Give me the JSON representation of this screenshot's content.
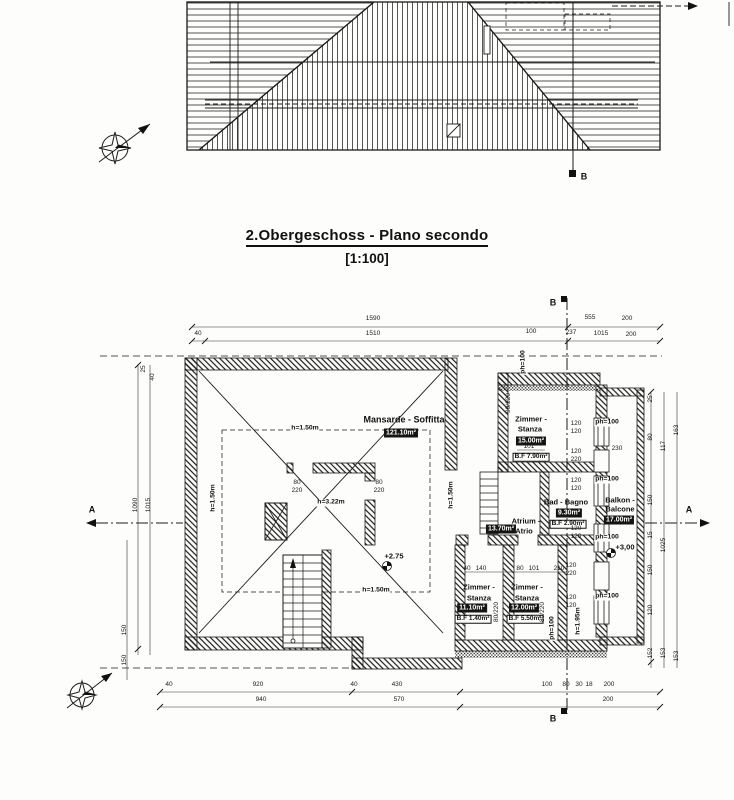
{
  "title": {
    "heading": "2.Obergeschoss - Plano secondo",
    "scale": "[1:100]"
  },
  "plan": {
    "rooms": {
      "mansarde": {
        "name": "Mansarde - Soffitta",
        "area": "121.10m²"
      },
      "zimmer_top": {
        "line1": "Zimmer -",
        "line2": "Stanza",
        "area": "15.00m²",
        "floor": "B.F 7.90m²"
      },
      "bad": {
        "name": "Bad - Bagno",
        "area": "9.30m²",
        "floor": "B.F 2.90m²"
      },
      "atrium": {
        "line1": "Atrium -",
        "line2": "Atrio",
        "area": "13.70m²"
      },
      "zimmer_sw": {
        "line1": "Zimmer -",
        "line2": "Stanza",
        "area": "11.10m²",
        "floor": "B.F 1.40m²"
      },
      "zimmer_s": {
        "line1": "Zimmer -",
        "line2": "Stanza",
        "area": "12.00m²",
        "floor": "B.F 5.50m²"
      },
      "balkon": {
        "line1": "Balkon -",
        "line2": "Balcone",
        "area": "17.00m²"
      }
    },
    "levels": {
      "mansarde": "+2.75",
      "balkon": "+3,00"
    },
    "sections": {
      "a": "A",
      "b": "B"
    }
  },
  "annotations": [
    {
      "t": "h=1.50m",
      "x": 305,
      "y": 429
    },
    {
      "t": "h=1.50m",
      "x": 214,
      "y": 498,
      "r": -90
    },
    {
      "t": "h=1.50m",
      "x": 452,
      "y": 495,
      "r": -90
    },
    {
      "t": "h=1.50m",
      "x": 376,
      "y": 591
    },
    {
      "t": "h=3.22m",
      "x": 331,
      "y": 503
    },
    {
      "t": "h=1.95m",
      "x": 579,
      "y": 621,
      "r": -90
    },
    {
      "t": "ph=100",
      "x": 607,
      "y": 423
    },
    {
      "t": "ph=100",
      "x": 607,
      "y": 480
    },
    {
      "t": "ph=100",
      "x": 607,
      "y": 538
    },
    {
      "t": "ph=100",
      "x": 607,
      "y": 597
    },
    {
      "t": "ph=100",
      "x": 524,
      "y": 362,
      "r": -90
    },
    {
      "t": "ph=100",
      "x": 553,
      "y": 628,
      "r": -90
    }
  ],
  "dimensions": [
    {
      "t": "1590",
      "x": 373,
      "y": 319
    },
    {
      "t": "40",
      "x": 198,
      "y": 334
    },
    {
      "t": "1510",
      "x": 373,
      "y": 334
    },
    {
      "t": "555",
      "x": 590,
      "y": 318
    },
    {
      "t": "200",
      "x": 627,
      "y": 319
    },
    {
      "t": "100",
      "x": 531,
      "y": 332
    },
    {
      "t": "237",
      "x": 571,
      "y": 333
    },
    {
      "t": "1015",
      "x": 601,
      "y": 334
    },
    {
      "t": "200",
      "x": 631,
      "y": 335
    },
    {
      "t": "25",
      "x": 144,
      "y": 369,
      "r": -90
    },
    {
      "t": "40",
      "x": 153,
      "y": 377,
      "r": -90
    },
    {
      "t": "1090",
      "x": 136,
      "y": 505,
      "r": -90
    },
    {
      "t": "1015",
      "x": 149,
      "y": 505,
      "r": -90
    },
    {
      "t": "150",
      "x": 125,
      "y": 630,
      "r": -90
    },
    {
      "t": "150",
      "x": 125,
      "y": 660,
      "r": -90
    },
    {
      "t": "40",
      "x": 169,
      "y": 685
    },
    {
      "t": "920",
      "x": 258,
      "y": 685
    },
    {
      "t": "40",
      "x": 354,
      "y": 685
    },
    {
      "t": "430",
      "x": 397,
      "y": 685
    },
    {
      "t": "100",
      "x": 547,
      "y": 685
    },
    {
      "t": "80",
      "x": 566,
      "y": 685
    },
    {
      "t": "30",
      "x": 579,
      "y": 685
    },
    {
      "t": "18",
      "x": 589,
      "y": 685
    },
    {
      "t": "200",
      "x": 609,
      "y": 685
    },
    {
      "t": "940",
      "x": 261,
      "y": 700
    },
    {
      "t": "570",
      "x": 399,
      "y": 700
    },
    {
      "t": "200",
      "x": 608,
      "y": 700
    },
    {
      "t": "25",
      "x": 651,
      "y": 399,
      "r": -90
    },
    {
      "t": "80",
      "x": 651,
      "y": 437,
      "r": -90
    },
    {
      "t": "150",
      "x": 651,
      "y": 500,
      "r": -90
    },
    {
      "t": "15",
      "x": 651,
      "y": 535,
      "r": -90
    },
    {
      "t": "150",
      "x": 651,
      "y": 570,
      "r": -90
    },
    {
      "t": "120",
      "x": 651,
      "y": 610,
      "r": -90
    },
    {
      "t": "152",
      "x": 651,
      "y": 653,
      "r": -90
    },
    {
      "t": "117",
      "x": 664,
      "y": 446,
      "r": -90
    },
    {
      "t": "1025",
      "x": 664,
      "y": 545,
      "r": -90
    },
    {
      "t": "153",
      "x": 664,
      "y": 653,
      "r": -90
    },
    {
      "t": "163",
      "x": 677,
      "y": 430,
      "r": -90
    },
    {
      "t": "153",
      "x": 677,
      "y": 656,
      "r": -90
    },
    {
      "t": "120",
      "x": 576,
      "y": 424
    },
    {
      "t": "120",
      "x": 576,
      "y": 432
    },
    {
      "t": "120",
      "x": 576,
      "y": 452
    },
    {
      "t": "220",
      "x": 576,
      "y": 460
    },
    {
      "t": "120",
      "x": 576,
      "y": 481
    },
    {
      "t": "120",
      "x": 576,
      "y": 489
    },
    {
      "t": "120",
      "x": 576,
      "y": 529
    },
    {
      "t": "120",
      "x": 576,
      "y": 537
    },
    {
      "t": "120",
      "x": 571,
      "y": 566
    },
    {
      "t": "220",
      "x": 571,
      "y": 574
    },
    {
      "t": "120",
      "x": 571,
      "y": 598
    },
    {
      "t": "120",
      "x": 571,
      "y": 606
    },
    {
      "t": "80",
      "x": 297,
      "y": 483
    },
    {
      "t": "220",
      "x": 297,
      "y": 491
    },
    {
      "t": "80",
      "x": 379,
      "y": 483
    },
    {
      "t": "220",
      "x": 379,
      "y": 491
    },
    {
      "t": "80/220",
      "x": 497,
      "y": 612,
      "r": -90
    },
    {
      "t": "80/220",
      "x": 543,
      "y": 612,
      "r": -90
    },
    {
      "t": "90/220",
      "x": 509,
      "y": 403,
      "r": -90
    },
    {
      "t": "40",
      "x": 467,
      "y": 569
    },
    {
      "t": "140",
      "x": 481,
      "y": 569
    },
    {
      "t": "80",
      "x": 520,
      "y": 569
    },
    {
      "t": "101",
      "x": 534,
      "y": 569
    },
    {
      "t": "210",
      "x": 559,
      "y": 569
    },
    {
      "t": "101",
      "x": 529,
      "y": 447
    },
    {
      "t": "230",
      "x": 617,
      "y": 449
    }
  ]
}
